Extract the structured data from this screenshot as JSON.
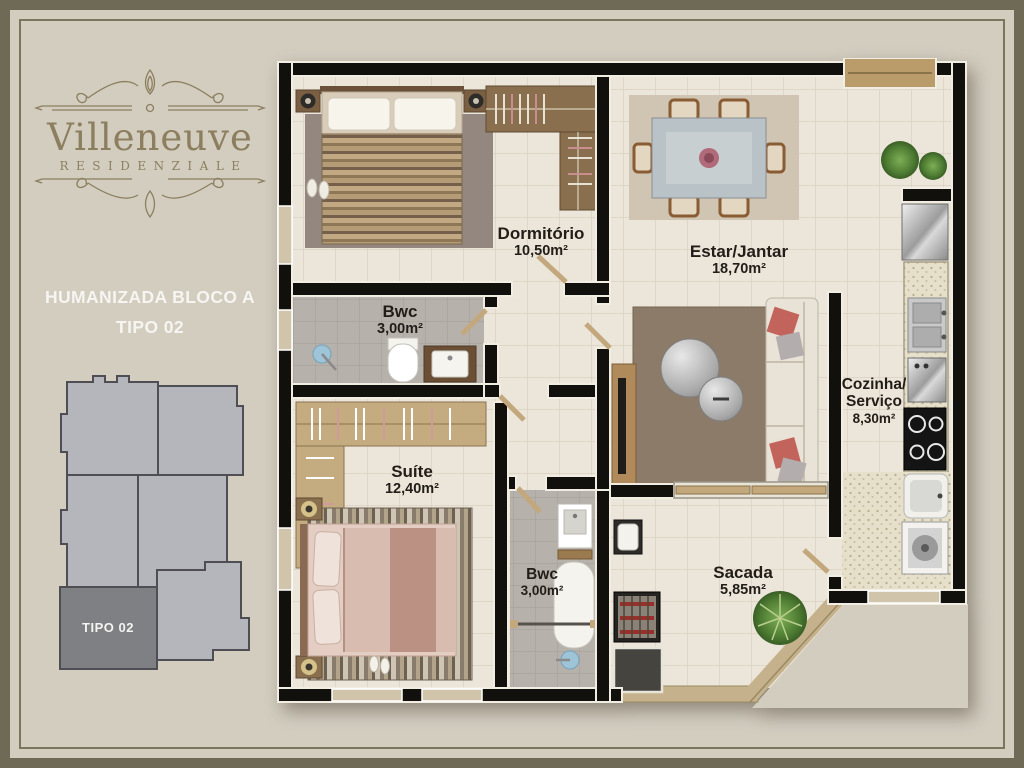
{
  "brand": {
    "name": "Villeneuve",
    "subtitle": "RESIDENZIALE"
  },
  "caption": {
    "line1": "HUMANIZADA BLOCO A",
    "line2": "TIPO 02"
  },
  "keyplan": {
    "highlight_label": "TIPO 02"
  },
  "rooms": {
    "dormitorio": {
      "name": "Dormitório",
      "area": "10,50m²"
    },
    "estar": {
      "name": "Estar/Jantar",
      "area": "18,70m²"
    },
    "bwc1": {
      "name": "Bwc",
      "area": "3,00m²"
    },
    "cozinha": {
      "name": "Cozinha/",
      "name2": "Serviço",
      "area": "8,30m²"
    },
    "suite": {
      "name": "Suíte",
      "area": "12,40m²"
    },
    "bwc2": {
      "name": "Bwc",
      "area": "3,00m²"
    },
    "sacada": {
      "name": "Sacada",
      "area": "5,85m²"
    }
  },
  "colors": {
    "frame": "#6f6a55",
    "background": "#d3cdc0",
    "brand_gold": "#8c7f5f",
    "wall": "#12100d",
    "floor": "#ece6da",
    "bath_floor": "#b7b1ab",
    "wood": "#c2a87c",
    "keyplan_fill": "#b5b6bc",
    "keyplan_highlight": "#7e8084",
    "label_text": "#221d18"
  }
}
